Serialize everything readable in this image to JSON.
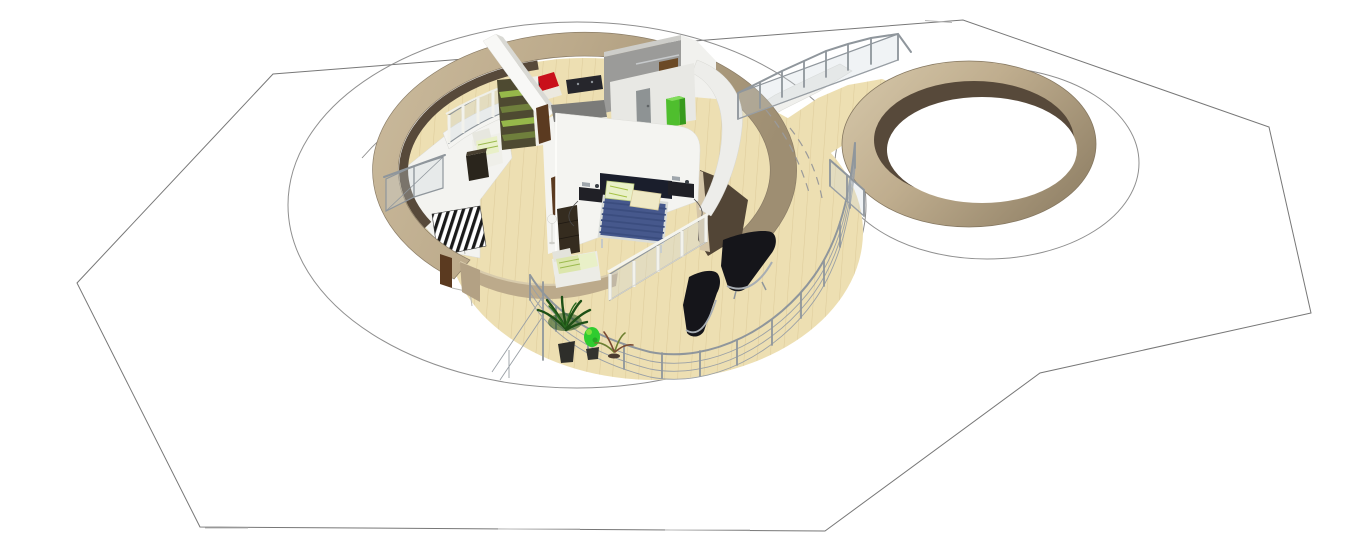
{
  "app": {
    "name": "3D home design viewer",
    "view": "Aerial dimetric 3D rendering of a circular single-storey house with open deck, connecting walkway and a round walled enclosure, placed on an octagonal terrain plot"
  },
  "colors": {
    "background": "#FFFFFF",
    "terrain_outline": "#777777",
    "terrain_edge_highlight": "#B8B8B8",
    "contour_line": "#8F8F8F",
    "tan_wall": "#BCAA8B",
    "tan_wall_light": "#D5C6A8",
    "tan_wall_dark": "#9A8A6F",
    "inner_wall_brown": "#57493A",
    "wood_floor": "#EDDFB2",
    "plank_line": "#C8A96A",
    "white_wall": "#F4F4F1",
    "white_wall_shadow": "#D9D9D4",
    "gray_wall": "#9B9B99",
    "counter_gray": "#7B7B79",
    "door_brown": "#5B3A20",
    "panel_brown": "#6B4A26",
    "door_gray": "#8E9394",
    "cabinet_green": "#4FBE2E",
    "shelf_green_bright": "#96B84A",
    "shelf_green_olive": "#6F7F3C",
    "daybed_red": "#C9101A",
    "sideboard_black": "#26262C",
    "bed_blue": "#46588C",
    "bed_stripe": "#3B4D7F",
    "bed_frame_white": "#D9DCD9",
    "bed_headboard": "#1A1E2C",
    "pillow_green": "#E9F0C8",
    "pillow_cream": "#EFE9C6",
    "nightstand_black": "#202026",
    "lounger_black": "#15151A",
    "chrome": "#A7ADB3",
    "railing_metal": "#8F969C",
    "railing_white": "#F2F2EC",
    "mezz_floor": "#F3F3F0",
    "paved_path": "#F0F0ED",
    "stair_dark": "#1A1A1A",
    "plant_dark_green": "#1E5016",
    "plant_bright_green": "#2FCC2F",
    "plant_fern_brown": "#7A4A32",
    "pot_dark": "#2E2E2A",
    "cabinet_dark_brown": "#352C1F",
    "box_dark_brown": "#2A251C"
  },
  "scene": {
    "terrain": {
      "plot_shape": "octagonal boundary polyline",
      "contour_rings": 2,
      "hidden_contours_dashed": 2
    },
    "main_house": {
      "shape": "circular perimeter wall with wide front opening onto a round wooden deck",
      "rooms": [
        "living area",
        "bedroom",
        "inner room with gray media wall"
      ],
      "furniture": [
        {
          "item": "double bed",
          "color_ref": "bed_blue",
          "pillows": 2,
          "nightstands": 2
        },
        {
          "item": "red daybed",
          "color_ref": "daybed_red"
        },
        {
          "item": "black sideboard",
          "color_ref": "sideboard_black"
        },
        {
          "item": "green shelving unit",
          "shelves": 4
        },
        {
          "item": "white armchair with green striped cushions",
          "count": 2
        },
        {
          "item": "dark media box",
          "color_ref": "box_dark_brown"
        },
        {
          "item": "tall dark-brown cabinet with floor lamp",
          "color_ref": "cabinet_dark_brown"
        },
        {
          "item": "lime-green cabinet",
          "color_ref": "cabinet_green"
        },
        {
          "item": "gray interior door",
          "color_ref": "door_gray"
        },
        {
          "item": "wooden doors",
          "count": 2,
          "color_ref": "door_brown"
        },
        {
          "item": "striped staircase to lower level",
          "color_ref": "stair_dark"
        }
      ],
      "deck": {
        "floor": "wood planks",
        "guard_rail": "metal posts with horizontal rails",
        "glass_balustrades": 3,
        "chaise_lounges": 2,
        "potted_plants": [
          {
            "type": "palm",
            "color_ref": "plant_dark_green"
          },
          {
            "type": "lime shrub",
            "color_ref": "plant_bright_green"
          },
          {
            "type": "fern",
            "color_ref": "plant_fern_brown"
          }
        ]
      }
    },
    "walkway": {
      "surface": "wood planks",
      "side_path": "light paved strip",
      "balustrade": "glass panels with metal posts",
      "connects": [
        "main house deck",
        "round enclosure"
      ]
    },
    "round_enclosure": {
      "shape": "empty circular tan wall (annulus), dark inner face on the upper-left",
      "interior": "empty / white"
    }
  }
}
